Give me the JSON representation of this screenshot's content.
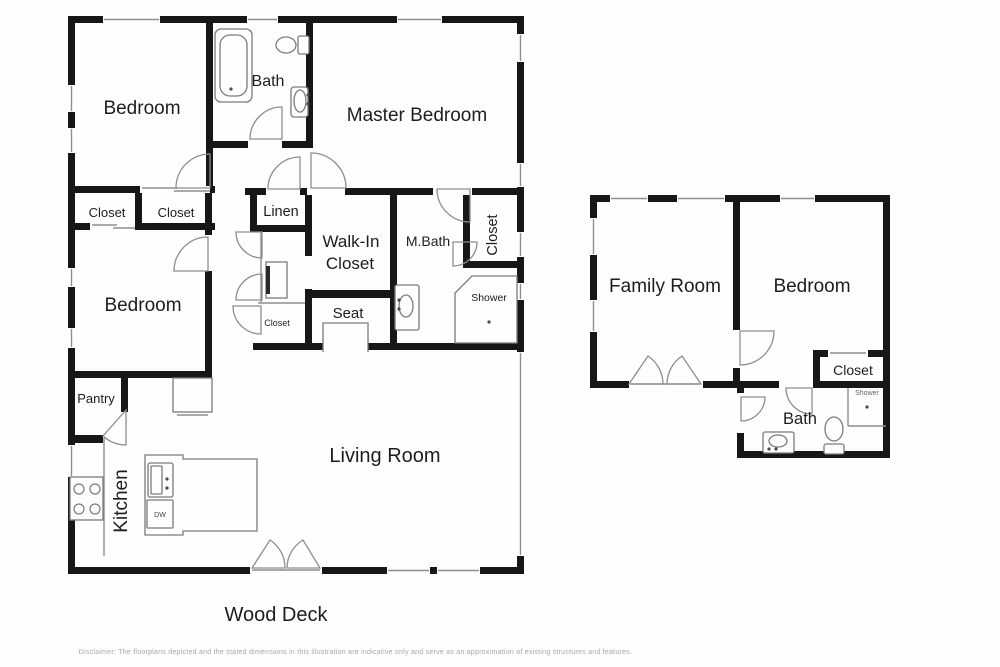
{
  "colors": {
    "bg": "#fefefe",
    "wall": "#171717",
    "line": "#8e8e8e",
    "fixture": "#7b7b7b",
    "label": "#1d1d1d"
  },
  "disclaimer": "Disclaimer: The floorplans depicted and the stated dimensions in this illustration are indicative only and serve as an approximation of existing structures and features.",
  "labels": [
    {
      "n": "bedroom-1",
      "t": "Bedroom",
      "x": 142,
      "y": 114,
      "s": 19,
      "r": 0
    },
    {
      "n": "bath-main",
      "t": "Bath",
      "x": 268,
      "y": 86,
      "s": 16,
      "r": 0
    },
    {
      "n": "master-bedroom",
      "t": "Master Bedroom",
      "x": 417,
      "y": 121,
      "s": 19,
      "r": 0
    },
    {
      "n": "closet-a",
      "t": "Closet",
      "x": 107,
      "y": 217,
      "s": 13,
      "r": 0
    },
    {
      "n": "closet-b",
      "t": "Closet",
      "x": 176,
      "y": 217,
      "s": 13,
      "r": 0
    },
    {
      "n": "linen",
      "t": "Linen",
      "x": 281,
      "y": 216,
      "s": 14.5,
      "r": 0
    },
    {
      "n": "walkin-line1",
      "t": "Walk-In",
      "x": 351,
      "y": 247,
      "s": 17,
      "r": 0
    },
    {
      "n": "walkin-line2",
      "t": "Closet",
      "x": 350,
      "y": 269,
      "s": 17,
      "r": 0
    },
    {
      "n": "m-bath",
      "t": "M.Bath",
      "x": 428,
      "y": 246,
      "s": 14,
      "r": 0
    },
    {
      "n": "closet-mbath",
      "t": "Closet",
      "x": 497,
      "y": 235,
      "s": 14.5,
      "r": -90
    },
    {
      "n": "shower-main",
      "t": "Shower",
      "x": 489,
      "y": 301,
      "s": 10.5,
      "r": 0
    },
    {
      "n": "seat",
      "t": "Seat",
      "x": 348,
      "y": 318,
      "s": 15,
      "r": 0
    },
    {
      "n": "closet-hall",
      "t": "Closet",
      "x": 277,
      "y": 326,
      "s": 9,
      "r": 0
    },
    {
      "n": "bedroom-2",
      "t": "Bedroom",
      "x": 143,
      "y": 311,
      "s": 19,
      "r": 0
    },
    {
      "n": "pantry",
      "t": "Pantry",
      "x": 96,
      "y": 403,
      "s": 13,
      "r": 0
    },
    {
      "n": "kitchen",
      "t": "Kitchen",
      "x": 127,
      "y": 501,
      "s": 19,
      "r": -90
    },
    {
      "n": "living-room",
      "t": "Living Room",
      "x": 385,
      "y": 462,
      "s": 20,
      "r": 0
    },
    {
      "n": "wood-deck",
      "t": "Wood Deck",
      "x": 276,
      "y": 621,
      "s": 20,
      "r": 0
    },
    {
      "n": "family-room",
      "t": "Family Room",
      "x": 665,
      "y": 292,
      "s": 19,
      "r": 0
    },
    {
      "n": "bedroom-3",
      "t": "Bedroom",
      "x": 812,
      "y": 292,
      "s": 19,
      "r": 0
    },
    {
      "n": "closet-right",
      "t": "Closet",
      "x": 853,
      "y": 375,
      "s": 14,
      "r": 0
    },
    {
      "n": "bath-right",
      "t": "Bath",
      "x": 800,
      "y": 424,
      "s": 16.5,
      "r": 0
    },
    {
      "n": "shower-right",
      "t": "Shower",
      "x": 867,
      "y": 395,
      "s": 7,
      "r": 0,
      "c": "#666666"
    },
    {
      "n": "dishwasher",
      "t": "DW",
      "x": 160,
      "y": 517,
      "s": 7,
      "r": 0,
      "c": "#444444"
    }
  ],
  "geometry": {
    "walls": [
      [
        68,
        16,
        456,
        7
      ],
      [
        68,
        16,
        7,
        558
      ],
      [
        517,
        16,
        7,
        558
      ],
      [
        68,
        567,
        456,
        7
      ],
      [
        68,
        186,
        147,
        7
      ],
      [
        206,
        16,
        7,
        177
      ],
      [
        306,
        16,
        7,
        132
      ],
      [
        212,
        141,
        101,
        7
      ],
      [
        68,
        223,
        147,
        7
      ],
      [
        135,
        186,
        7,
        44
      ],
      [
        205,
        186,
        7,
        192
      ],
      [
        68,
        371,
        144,
        7
      ],
      [
        305,
        188,
        219,
        7
      ],
      [
        250,
        188,
        7,
        44
      ],
      [
        255,
        225,
        52,
        7
      ],
      [
        305,
        188,
        7,
        162
      ],
      [
        305,
        290,
        92,
        8
      ],
      [
        390,
        195,
        7,
        155
      ],
      [
        253,
        343,
        70,
        7
      ],
      [
        368,
        343,
        29,
        7
      ],
      [
        463,
        195,
        7,
        73
      ],
      [
        463,
        261,
        61,
        7
      ],
      [
        390,
        343,
        134,
        7
      ],
      [
        121,
        378,
        7,
        34
      ],
      [
        68,
        435,
        35,
        8
      ],
      [
        245,
        188,
        62,
        7
      ],
      [
        590,
        195,
        300,
        7
      ],
      [
        590,
        195,
        7,
        193
      ],
      [
        883,
        195,
        7,
        263
      ],
      [
        590,
        381,
        150,
        7
      ],
      [
        733,
        195,
        7,
        193
      ],
      [
        740,
        381,
        150,
        7
      ],
      [
        813,
        350,
        7,
        38
      ],
      [
        813,
        350,
        77,
        7
      ],
      [
        737,
        388,
        7,
        70
      ],
      [
        737,
        451,
        153,
        7
      ]
    ],
    "openings": [
      [
        103,
        16,
        57,
        7,
        "h"
      ],
      [
        247,
        16,
        31,
        7,
        "h"
      ],
      [
        397,
        16,
        45,
        7,
        "h"
      ],
      [
        68,
        85,
        7,
        27,
        "v"
      ],
      [
        68,
        128,
        7,
        25,
        "v"
      ],
      [
        68,
        268,
        7,
        19,
        "v"
      ],
      [
        68,
        328,
        7,
        20,
        "v"
      ],
      [
        68,
        445,
        7,
        32,
        "v"
      ],
      [
        517,
        34,
        7,
        28,
        "v"
      ],
      [
        517,
        163,
        7,
        24,
        "v"
      ],
      [
        517,
        232,
        7,
        25,
        "v"
      ],
      [
        517,
        283,
        7,
        17,
        "v"
      ],
      [
        517,
        352,
        7,
        204,
        "v"
      ],
      [
        250,
        567,
        72,
        7,
        ""
      ],
      [
        387,
        567,
        43,
        7,
        "h"
      ],
      [
        437,
        567,
        43,
        7,
        "h"
      ],
      [
        610,
        195,
        38,
        7,
        "h"
      ],
      [
        677,
        195,
        48,
        7,
        "h"
      ],
      [
        780,
        195,
        35,
        7,
        "h"
      ],
      [
        590,
        218,
        7,
        37,
        "v"
      ],
      [
        590,
        300,
        7,
        32,
        "v"
      ],
      [
        629,
        381,
        74,
        7,
        ""
      ],
      [
        733,
        330,
        7,
        38,
        ""
      ],
      [
        307,
        188,
        38,
        7,
        ""
      ],
      [
        433,
        188,
        39,
        7,
        ""
      ],
      [
        248,
        141,
        34,
        7,
        ""
      ],
      [
        205,
        235,
        7,
        36,
        ""
      ],
      [
        737,
        393,
        7,
        40,
        ""
      ],
      [
        779,
        381,
        34,
        7,
        ""
      ],
      [
        140,
        186,
        70,
        7,
        ""
      ],
      [
        90,
        223,
        45,
        7,
        ""
      ],
      [
        828,
        350,
        40,
        7,
        ""
      ],
      [
        266,
        188,
        34,
        7,
        ""
      ],
      [
        176,
        186,
        33,
        7,
        ""
      ],
      [
        305,
        256,
        7,
        33,
        ""
      ]
    ],
    "lines": [
      [
        252,
        570,
        320,
        570
      ],
      [
        631,
        384,
        699,
        384
      ],
      [
        142,
        188,
        178,
        188
      ],
      [
        174,
        191,
        210,
        191
      ],
      [
        92,
        225,
        117,
        225
      ],
      [
        113,
        228,
        135,
        228
      ],
      [
        830,
        353,
        866,
        353
      ],
      [
        104,
        438,
        104,
        556
      ],
      [
        261,
        232,
        261,
        302
      ],
      [
        258,
        303,
        305,
        303
      ],
      [
        177,
        415,
        208,
        415
      ],
      [
        848,
        388,
        848,
        426
      ],
      [
        848,
        426,
        886,
        426
      ]
    ],
    "doors": [
      {
        "n": "door-bedroom-1",
        "d": "M210,188 L210,154 A34,34 0 0 0 176,188 Z"
      },
      {
        "n": "door-bath-main",
        "d": "M282,139 L282,107 A32,32 0 0 0 250,139 Z"
      },
      {
        "n": "door-master",
        "d": "M311,188 L311,153 A35,35 0 0 1 346,188 Z"
      },
      {
        "n": "door-linen",
        "d": "M300,189 L300,157 A32,32 0 0 0 268,189 Z"
      },
      {
        "n": "door-utility-top",
        "d": "M262,232 L236,232 A26,26 0 0 0 262,258 Z"
      },
      {
        "n": "door-utility-bottom",
        "d": "M262,300 L236,300 A26,26 0 0 1 262,274 Z"
      },
      {
        "n": "door-hall-closet",
        "d": "M261,306 L233,306 A28,28 0 0 0 261,334 Z"
      },
      {
        "n": "door-mbath",
        "d": "M470,189 L437,189 A33,33 0 0 0 470,222 Z"
      },
      {
        "n": "door-shower-main",
        "d": "M453,242 L477,242 A24,24 0 0 1 453,266 Z"
      },
      {
        "n": "door-bedroom-2",
        "d": "M208,271 L208,237 A34,34 0 0 0 174,271 Z"
      },
      {
        "n": "door-pantry",
        "d": "M126,410 L103,436 A35,35 0 0 0 126,445 Z"
      },
      {
        "n": "door-deck-left",
        "d": "M252,568 L270,540 A33,33 0 0 1 285,568 Z"
      },
      {
        "n": "door-deck-right",
        "d": "M320,568 L303,540 A33,33 0 0 0 287,568 Z"
      },
      {
        "n": "door-family-left",
        "d": "M629,384 L648,356 A34,34 0 0 1 663,384 Z"
      },
      {
        "n": "door-family-right",
        "d": "M701,384 L682,356 A34,34 0 0 0 667,384 Z"
      },
      {
        "n": "door-bedroom-3",
        "d": "M740,331 L774,331 A34,34 0 0 1 740,365 Z"
      },
      {
        "n": "door-bath-right",
        "d": "M741,397 L765,397 A24,24 0 0 1 741,421 Z"
      },
      {
        "n": "door-closet-right",
        "d": "M812,388 L812,414 A26,26 0 0 1 786,388 Z"
      }
    ],
    "paths": [
      {
        "n": "kitchen-island",
        "d": "M145,455 L183,455 L183,459 L257,459 L257,531 L183,531 L183,535 L145,535 Z",
        "f": 1
      },
      {
        "n": "shower-stall-main",
        "d": "M472,276 L517,276 L517,343 L455,343 L455,293 Z",
        "f": 1
      },
      {
        "n": "seat-nook",
        "d": "M323,352 L323,323 L368,323 L368,352",
        "f": 0
      },
      {
        "n": "appliance-x-marks",
        "d": "M173,378 L212,412 M212,378 L173,412",
        "f": 0
      }
    ],
    "fixtures": {
      "rects": [
        {
          "n": "bathtub-outer",
          "r": [
            215,
            29,
            37,
            73,
            6
          ]
        },
        {
          "n": "bathtub-inner",
          "r": [
            220,
            35,
            27,
            61,
            10
          ]
        },
        {
          "n": "toilet-tank-main",
          "r": [
            298,
            36,
            11,
            18,
            2
          ]
        },
        {
          "n": "sink-cabinet-main-bath",
          "r": [
            291,
            87,
            17,
            30,
            3
          ]
        },
        {
          "n": "water-heater",
          "r": [
            266,
            262,
            21,
            36,
            0
          ]
        },
        {
          "n": "appliance-x-box",
          "r": [
            173,
            378,
            39,
            34,
            0
          ]
        },
        {
          "n": "stove",
          "r": [
            70,
            477,
            33,
            43,
            0
          ]
        },
        {
          "n": "island-sink",
          "r": [
            148,
            463,
            25,
            34,
            2
          ]
        },
        {
          "n": "island-sink-basin",
          "r": [
            151,
            466,
            11,
            28,
            1
          ]
        },
        {
          "n": "dishwasher-box",
          "r": [
            147,
            500,
            26,
            28,
            1
          ]
        },
        {
          "n": "mbath-vanity",
          "r": [
            395,
            285,
            24,
            45,
            2
          ]
        },
        {
          "n": "right-bath-vanity",
          "r": [
            763,
            432,
            31,
            21,
            2
          ]
        },
        {
          "n": "right-toilet-tank",
          "r": [
            824,
            444,
            20,
            10,
            2
          ]
        }
      ],
      "filled_rects": [
        {
          "n": "water-heater-bar",
          "r": [
            266,
            266,
            4,
            28
          ]
        }
      ],
      "ellipses": [
        {
          "n": "toilet-bowl-main",
          "e": [
            286,
            45,
            10,
            8
          ]
        },
        {
          "n": "sink-oval-main-bath",
          "e": [
            300,
            101,
            6,
            11
          ]
        },
        {
          "n": "mbath-sink-oval",
          "e": [
            406,
            306,
            7,
            11
          ]
        },
        {
          "n": "right-bath-sink-oval",
          "e": [
            778,
            441,
            9,
            6
          ]
        },
        {
          "n": "right-toilet-bowl",
          "e": [
            834,
            429,
            9,
            12
          ]
        }
      ],
      "circles": [
        {
          "n": "burner",
          "c": [
            79,
            489,
            5
          ]
        },
        {
          "n": "burner",
          "c": [
            95,
            489,
            5
          ]
        },
        {
          "n": "burner",
          "c": [
            79,
            509,
            5
          ]
        },
        {
          "n": "burner",
          "c": [
            95,
            509,
            5
          ]
        }
      ],
      "dots": [
        [
          231,
          89
        ],
        [
          489,
          322
        ],
        [
          867,
          407
        ],
        [
          308,
          95
        ],
        [
          308,
          104
        ],
        [
          399,
          300
        ],
        [
          399,
          309
        ],
        [
          167,
          479
        ],
        [
          167,
          488
        ],
        [
          769,
          449
        ],
        [
          776,
          449
        ]
      ]
    }
  }
}
